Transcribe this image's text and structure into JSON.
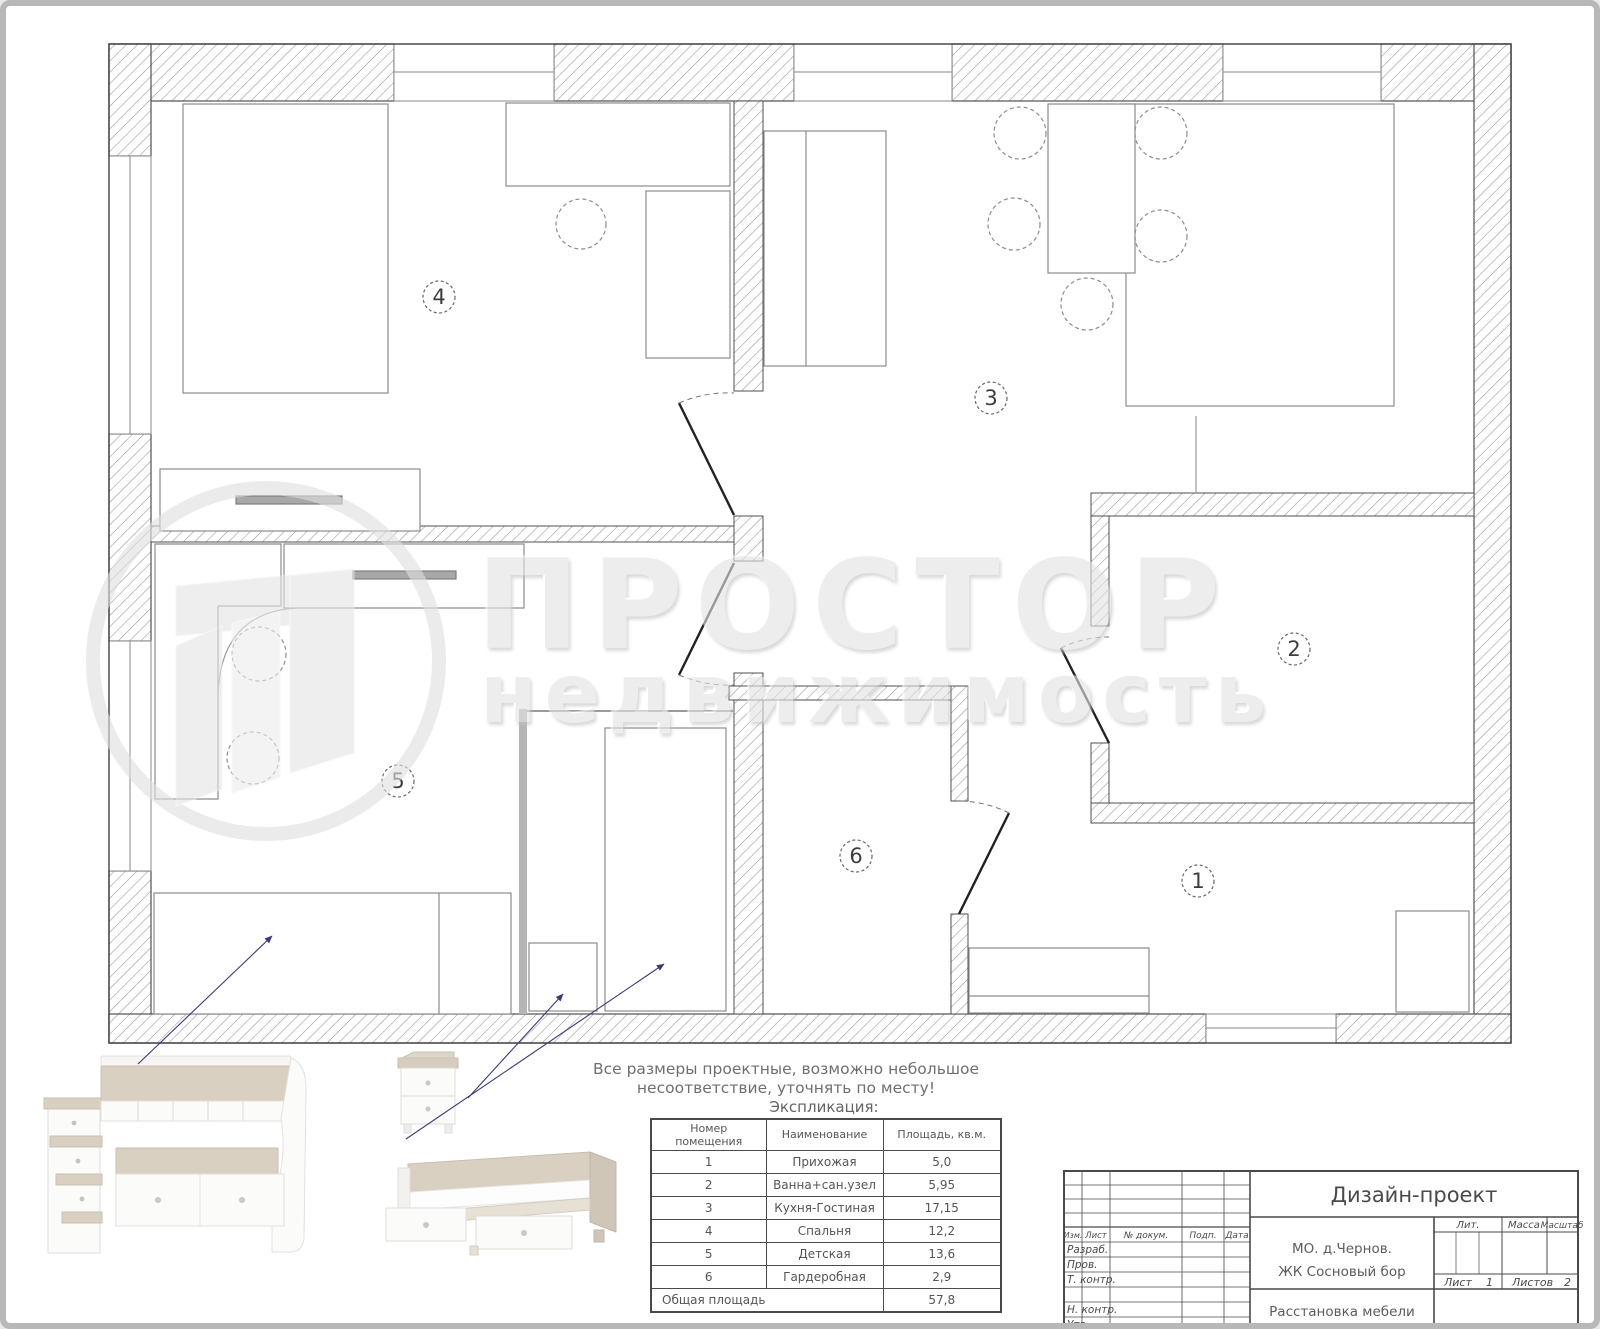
{
  "watermark": {
    "brand_line1": "ПРОСТОР",
    "brand_line2": "недвижимость"
  },
  "note": {
    "line1": "Все размеры проектные, возможно небольшое",
    "line2": "несоответствие, уточнять по месту!"
  },
  "legend": {
    "title": "Экспликация:",
    "columns": {
      "number_line1": "Номер",
      "number_line2": "помещения",
      "name": "Наименование",
      "area": "Площадь, кв.м."
    },
    "total_label": "Общая площадь",
    "total_value": "57,8"
  },
  "rooms": [
    {
      "number": "1",
      "name": "Прихожая",
      "area": "5,0"
    },
    {
      "number": "2",
      "name": "Ванна+сан.узел",
      "area": "5,95"
    },
    {
      "number": "3",
      "name": "Кухня-Гостиная",
      "area": "17,15"
    },
    {
      "number": "4",
      "name": "Спальня",
      "area": "12,2"
    },
    {
      "number": "5",
      "name": "Детская",
      "area": "13,6"
    },
    {
      "number": "6",
      "name": "Гардеробная",
      "area": "2,9"
    }
  ],
  "titleblock": {
    "doc_title": "Дизайн-проект",
    "object_line1": "МО. д.Чернов.",
    "object_line2": "ЖК Сосновый бор",
    "sheet_title": "Расстановка мебели",
    "cols": {
      "izm": "Изм.",
      "list": "Лист",
      "dokum": "№ докум.",
      "podp": "Подп.",
      "data": "Дата"
    },
    "rows": {
      "razrab": "Разраб.",
      "prov": "Пров.",
      "tkontr": "Т. контр.",
      "nkontr": "Н. контр.",
      "utv": "Утв."
    },
    "stamp": {
      "lit": "Лит.",
      "massa": "Масса",
      "masshtab": "Масштаб",
      "list_label": "Лист",
      "list_value": "1",
      "listov_label": "Листов",
      "listov_value": "2"
    }
  }
}
